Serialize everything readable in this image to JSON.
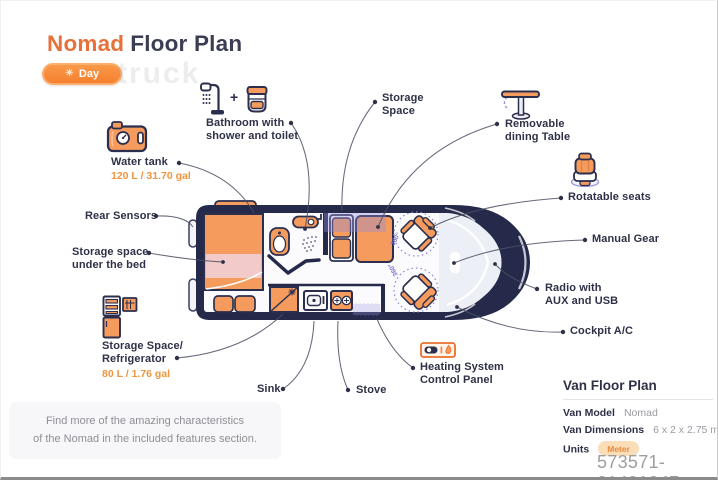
{
  "header": {
    "title_accent": "Nomad",
    "title_rest": "Floor Plan",
    "day_toggle": "Day"
  },
  "icons": {
    "sun": "☀",
    "plus": "+"
  },
  "callouts": {
    "water_tank": {
      "label": "Water tank",
      "value": "120 L / 31.70 gal"
    },
    "bathroom": {
      "label": "Bathroom with\nshower and toilet"
    },
    "storage_space": {
      "label": "Storage\nSpace"
    },
    "dining_table": {
      "label": "Removable\ndining Table"
    },
    "rotatable_seats": {
      "label": "Rotatable seats"
    },
    "rear_sensors": {
      "label": "Rear Sensors"
    },
    "storage_under_bed": {
      "label": "Storage space\nunder the bed"
    },
    "manual_gear": {
      "label": "Manual Gear"
    },
    "radio": {
      "label": "Radio with\nAUX and USB"
    },
    "cockpit_ac": {
      "label": "Cockpit A/C"
    },
    "fridge": {
      "label": "Storage Space/\nRefrigerator",
      "value": "80 L / 1.76 gal"
    },
    "sink": {
      "label": "Sink"
    },
    "stove": {
      "label": "Stove"
    },
    "heating": {
      "label": "Heating System\nControl Panel"
    }
  },
  "floorplan": {
    "rotation_label": "360°"
  },
  "note": "Find more of the amazing characteristics\nof the Nomad in the included features section.",
  "info_panel": {
    "title": "Van Floor Plan",
    "rows": [
      {
        "label": "Van Model",
        "value": "Nomad"
      },
      {
        "label": "Van Dimensions",
        "value": "6 x 2 x 2.75 m"
      },
      {
        "label": "Units",
        "value": "Meter"
      }
    ]
  },
  "watermarks": {
    "background_text": "truck",
    "id_text": "573571-21491347"
  }
}
